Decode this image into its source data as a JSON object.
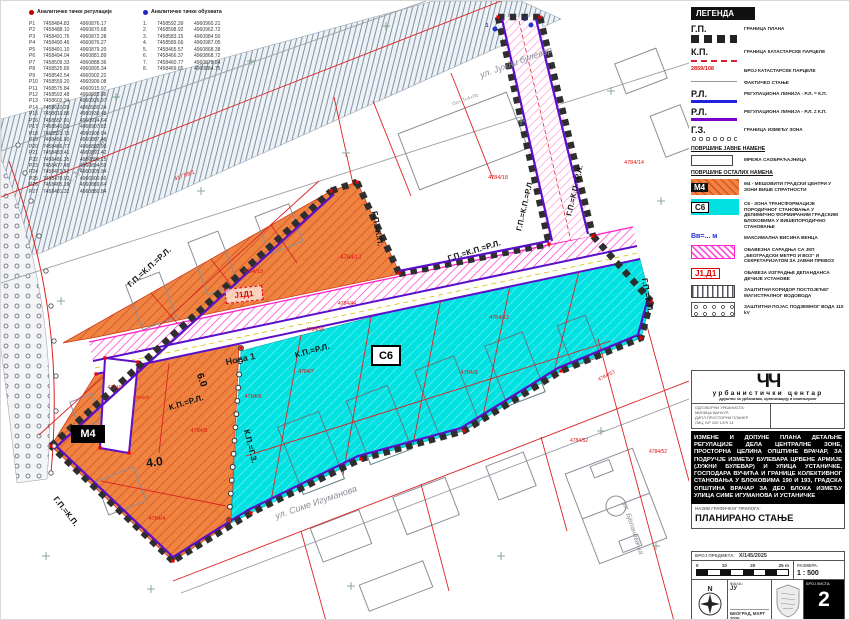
{
  "tables": {
    "regulation": {
      "title": "Аналитичке тачке регулације",
      "rows": [
        [
          "Р1",
          "7458484.83",
          "4960876.17"
        ],
        [
          "Р2",
          "7458488.10",
          "4960870.68"
        ],
        [
          "Р3",
          "7458491.76",
          "4960872.28"
        ],
        [
          "Р4",
          "7458490.46",
          "4960876.27"
        ],
        [
          "Р5",
          "7458491.10",
          "4960879.20"
        ],
        [
          "Р6",
          "7458494.04",
          "4960881.89"
        ],
        [
          "Р7",
          "7458509.33",
          "4960888.36"
        ],
        [
          "Р8",
          "7458525.89",
          "4960895.34"
        ],
        [
          "Р9",
          "7458542.54",
          "4960902.22"
        ],
        [
          "Р10",
          "7458559.20",
          "4960909.08"
        ],
        [
          "Р11",
          "7458575.84",
          "4960915.97"
        ],
        [
          "Р12",
          "7458592.48",
          "4960922.86"
        ],
        [
          "Р13",
          "7458602.34",
          "4960926.97"
        ],
        [
          "Р14",
          "7458610.29",
          "4960930.24"
        ],
        [
          "Р15",
          "7458610.88",
          "4960930.48"
        ],
        [
          "Р16",
          "7458557.01",
          "4960914.64"
        ],
        [
          "Р17",
          "7458540.36",
          "4960907.82"
        ],
        [
          "Р18",
          "7458523.73",
          "4960900.94"
        ],
        [
          "Р19",
          "7458491.60",
          "4960887.48"
        ],
        [
          "Р20",
          "7458486.77",
          "4960887.90"
        ],
        [
          "Р21",
          "7458483.41",
          "4960891.42"
        ],
        [
          "Р22",
          "7458481.35",
          "4960896.15"
        ],
        [
          "Р23",
          "7458477.48",
          "4960894.59"
        ],
        [
          "Р24",
          "7458473.51",
          "4960905.94"
        ],
        [
          "Р25",
          "7458470.02",
          "4960900.60"
        ],
        [
          "Р26",
          "7458465.19",
          "4960889.64"
        ],
        [
          "Р27",
          "7458481.32",
          "4960880.84"
        ]
      ]
    },
    "coverage": {
      "title": "Аналитичке тачке обухвата",
      "rows": [
        [
          "1.",
          "7458592.39",
          "4960960.21"
        ],
        [
          "2.",
          "7458598.92",
          "4960962.72"
        ],
        [
          "3.",
          "7458583.15",
          "4960984.50"
        ],
        [
          "4.",
          "7458589.66",
          "4960987.05"
        ],
        [
          "5.",
          "7458465.57",
          "4960868.38"
        ],
        [
          "6.",
          "7458466.37",
          "4960868.72"
        ],
        [
          "7.",
          "7458460.77",
          "4960879.84"
        ],
        [
          "8.",
          "7458469.65",
          "4960884.75"
        ]
      ]
    }
  },
  "legend": {
    "title": "ЛЕГЕНДА",
    "items": [
      {
        "type": "gp",
        "sym": "Г.П.",
        "label": "ГРАНИЦА ПЛАНА"
      },
      {
        "type": "kp",
        "sym": "К.П.",
        "label": "ГРАНИЦА КАТАСТАРСКЕ ПАРЦЕЛЕ"
      },
      {
        "type": "parcel",
        "sym": "2859/108",
        "label": "БРОЈ КАТАСТАРСКЕ ПАРЦЕЛЕ"
      },
      {
        "type": "fact",
        "sym": "",
        "label": "ФАКТИЧКО СТАЊЕ"
      },
      {
        "type": "rl1",
        "sym": "Р.Л.",
        "label": "РЕГУЛАЦИОНА ЛИНИЈА - Р.Л. = К.П."
      },
      {
        "type": "rl2",
        "sym": "Р.Л.",
        "label": "РЕГУЛАЦИОНА ЛИНИЈА - Р.Л. ≠ К.П."
      },
      {
        "type": "gz",
        "sym": "Г.З.",
        "label": "ГРАНИЦА ИЗМЕЂУ ЗОНА"
      },
      {
        "type": "h",
        "sym": "",
        "label": "ПОВРШИНЕ ЈАВНЕ НАМЕНЕ"
      },
      {
        "type": "road",
        "sym": "",
        "label": "МРЕЖА САОБРАЋАЈНИЦА"
      },
      {
        "type": "h",
        "sym": "",
        "label": "ПОВРШИНЕ ОСТАЛИХ НАМЕНА"
      },
      {
        "type": "m4",
        "sym": "М4",
        "label": "М4 - МЕШОВИТИ ГРАДСКИ ЦЕНТРИ У ЗОНИ ВИШЕ СПРАТНОСТИ"
      },
      {
        "type": "s6",
        "sym": "С6",
        "label": "С6 - ЗОНА ТРАНСФОРМАЦИЈЕ ПОРОДИЧНОГ СТАНОВАЊА У ДЕЛИМИЧНО ФОРМИРАНИМ ГРАДСКИМ БЛОКОВИМА У ВИШЕПОРОДИЧНО СТАНОВАЊЕ"
      },
      {
        "type": "vv",
        "sym": "Вв=... м",
        "label": "МАКСИМАЛНА ВИСИНА ВЕНЦА"
      },
      {
        "type": "metro",
        "sym": "",
        "label": "ОБАВЕЗНА  САРАДЊА СА ЈКП „БЕОГРАДСКИ МЕТРО И ВОЗ“ И СЕКРЕТАРИЈАТОМ ЗА ЈАВНИ ПРЕВОЗ"
      },
      {
        "type": "j1d1",
        "sym": "Ј1,Д1",
        "label": "ОБАВЕЗА ИЗГРАДЊЕ ДЕПАНДАНСА ДЕЧИЈЕ УСТАНОВЕ"
      },
      {
        "type": "vodovod",
        "sym": "",
        "label": "ЗАШТИТНИ КОРИДОР ПОСТОЈЕЋЕГ МАГИСТРАЛНОГ ВОДОВОДА"
      },
      {
        "type": "kv",
        "sym": "",
        "label": "ЗАШТИТНИ ПОЈАС ПОДЗЕМНОГ ВОДА 110 kV"
      }
    ]
  },
  "map": {
    "zones": {
      "m4": "М4",
      "s6": "С6",
      "j1d1": "Ј1Д1"
    },
    "labels": [
      {
        "t": "ул. Јужни булевар",
        "x": 516,
        "y": 64,
        "r": -20,
        "c": "street",
        "s": 9
      },
      {
        "t": "ул. Јужни булевар",
        "x": 86,
        "y": 162,
        "r": -52,
        "c": "street",
        "s": 7
      },
      {
        "t": "ул. Симе Игуманова",
        "x": 316,
        "y": 504,
        "r": -19,
        "c": "street",
        "s": 9
      },
      {
        "t": "ул. Бјелановачка",
        "x": 630,
        "y": 528,
        "r": 72,
        "c": "street",
        "s": 7
      },
      {
        "t": "Нова 1",
        "x": 240,
        "y": 361,
        "r": -12,
        "c": "streetd",
        "s": 9
      },
      {
        "t": "Г.П.=К.П.=Р.Л.",
        "x": 150,
        "y": 268,
        "r": -42,
        "c": "reg",
        "s": 8
      },
      {
        "t": "Г.П.=К.П.",
        "x": 374,
        "y": 228,
        "r": 80,
        "c": "reg",
        "s": 8
      },
      {
        "t": "Г.П.=К.П.=Р.Л.",
        "x": 474,
        "y": 252,
        "r": -17,
        "c": "reg",
        "s": 8
      },
      {
        "t": "Г.П.=К.П.=Р.Л.",
        "x": 526,
        "y": 205,
        "r": -77,
        "c": "reg",
        "s": 7.5
      },
      {
        "t": "Г.П.=К.П.=Р.Л.",
        "x": 576,
        "y": 190,
        "r": -77,
        "c": "reg",
        "s": 7.5
      },
      {
        "t": "К.П.=Р.Л.",
        "x": 186,
        "y": 404,
        "r": -17,
        "c": "reg",
        "s": 8
      },
      {
        "t": "К.П.=Р.Л.",
        "x": 312,
        "y": 352,
        "r": -15,
        "c": "reg",
        "s": 8
      },
      {
        "t": "К.П.=Г.З.",
        "x": 247,
        "y": 446,
        "r": 76,
        "c": "reg",
        "s": 8
      },
      {
        "t": "Г.П.=К.П.",
        "x": 63,
        "y": 512,
        "r": 52,
        "c": "reg",
        "s": 8
      },
      {
        "t": "Г.П.=К.П.",
        "x": 644,
        "y": 295,
        "r": 80,
        "c": "reg",
        "s": 8
      },
      {
        "t": "6.0",
        "x": 198,
        "y": 380,
        "r": 70,
        "c": "dim",
        "s": 10
      },
      {
        "t": "4.0",
        "x": 154,
        "y": 465,
        "r": -8,
        "c": "dim",
        "s": 12
      },
      {
        "t": "4177/8/1",
        "x": 184,
        "y": 176,
        "r": -20,
        "c": "red",
        "s": 5.5
      },
      {
        "t": "4784/17",
        "x": 350,
        "y": 258,
        "r": 0,
        "c": "red",
        "s": 6
      },
      {
        "t": "4784/13",
        "x": 252,
        "y": 272,
        "r": 0,
        "c": "red",
        "s": 5.5
      },
      {
        "t": "4784/18",
        "x": 497,
        "y": 178,
        "r": 0,
        "c": "red",
        "s": 5.5
      },
      {
        "t": "4784/14",
        "x": 633,
        "y": 163,
        "r": 0,
        "c": "red",
        "s": 5.5
      },
      {
        "t": "4784/44",
        "x": 346,
        "y": 304,
        "r": 0,
        "c": "red",
        "s": 5
      },
      {
        "t": "4784/58",
        "x": 314,
        "y": 330,
        "r": 0,
        "c": "red",
        "s": 5
      },
      {
        "t": "4784/12",
        "x": 498,
        "y": 318,
        "r": 0,
        "c": "red",
        "s": 5.5
      },
      {
        "t": "4784/7",
        "x": 305,
        "y": 372,
        "r": 0,
        "c": "red",
        "s": 5
      },
      {
        "t": "4784/8",
        "x": 252,
        "y": 397,
        "r": 0,
        "c": "red",
        "s": 5.5
      },
      {
        "t": "4784/9",
        "x": 468,
        "y": 373,
        "r": 0,
        "c": "red",
        "s": 5.5
      },
      {
        "t": "4784/2",
        "x": 114,
        "y": 388,
        "r": 0,
        "c": "red",
        "s": 5
      },
      {
        "t": "4784/20",
        "x": 140,
        "y": 398,
        "r": 0,
        "c": "red",
        "s": 4.5
      },
      {
        "t": "4784/5",
        "x": 198,
        "y": 431,
        "r": 0,
        "c": "red",
        "s": 5.5
      },
      {
        "t": "4784/4",
        "x": 156,
        "y": 519,
        "r": 0,
        "c": "red",
        "s": 5.5
      },
      {
        "t": "4784/63",
        "x": 606,
        "y": 376,
        "r": -27,
        "c": "red",
        "s": 5
      },
      {
        "t": "4784/52",
        "x": 578,
        "y": 441,
        "r": 0,
        "c": "red",
        "s": 5
      },
      {
        "t": "4784/52",
        "x": 657,
        "y": 452,
        "r": 0,
        "c": "red",
        "s": 5
      },
      {
        "t": "По+П+4+Пс",
        "x": 465,
        "y": 100,
        "r": -20,
        "c": "bldg",
        "s": 5
      },
      {
        "t": "1",
        "x": 486,
        "y": 26,
        "r": 0,
        "c": "blue",
        "s": 5.5
      },
      {
        "t": "2",
        "x": 524,
        "y": 20,
        "r": 0,
        "c": "blue",
        "s": 5.5
      }
    ]
  },
  "title_block": {
    "firm": {
      "logo": "ЧЧ",
      "name": "урбанистички центар",
      "tagline": "друштво за урбанизам, организацију и инжењеринг"
    },
    "responsible": {
      "lines": [
        "ОДГОВОРНИ УРБАНИСТА:",
        "МИЛИЦА ВАНЧУР,",
        "ДИПЛ.ПРОСТОРНИ ПЛАНЕР",
        "ЛИЦ. БР. 200 1470 14"
      ]
    },
    "project_title": "ИЗМЕНЕ И ДОПУНЕ ПЛАНА ДЕТАЉНЕ РЕГУЛАЦИЈЕ ДЕЛА ЦЕНТРАЛНЕ ЗОНЕ, ПРОСТОРНА ЦЕЛИНА ОПШТИНЕ ВРАЧАР, ЗА ПОДРУЧЈЕ ИЗМЕЂУ БУЛЕВАРА ЦРВЕНЕ АРМИЈЕ (ЈУЖНИ БУЛЕВАР) И УЛИЦА УСТАНИЧКЕ, ГОСПОДАРА ВУЧИЋА И ГРАНИЦЕ КОЛЕКТИВНОГ СТАНОВАЊА У БЛОКОВИМА 190 И 193, ГРАДСКА ОПШТИНА ВРАЧАР ЗА ДЕО БЛОКА ИЗМЕЂУ УЛИЦА СИМЕ ИГУМАНОВА И УСТАНИЧКЕ",
    "drawing": {
      "label": "НАЗИВ ГРАФИЧКОГ ПРИЛОГА:",
      "name": "ПЛАНИРАНО СТАЊЕ"
    },
    "case": {
      "label": "БРОЈ ПРЕДМЕТА:",
      "value": "X/145/2025"
    },
    "scale": {
      "label": "РАЗМЕРА:",
      "value": "1 : 500",
      "ticks": [
        "0",
        "10",
        "20",
        "25"
      ],
      "unit": "m"
    },
    "phase": {
      "label": "ФАЗА:",
      "value": "ЈУ"
    },
    "place_date": "БЕОГРАД, МАРТ 2025.",
    "sheet": {
      "label": "БРОЈ ЛИСТА:",
      "value": "2"
    },
    "compass_n": "N"
  }
}
